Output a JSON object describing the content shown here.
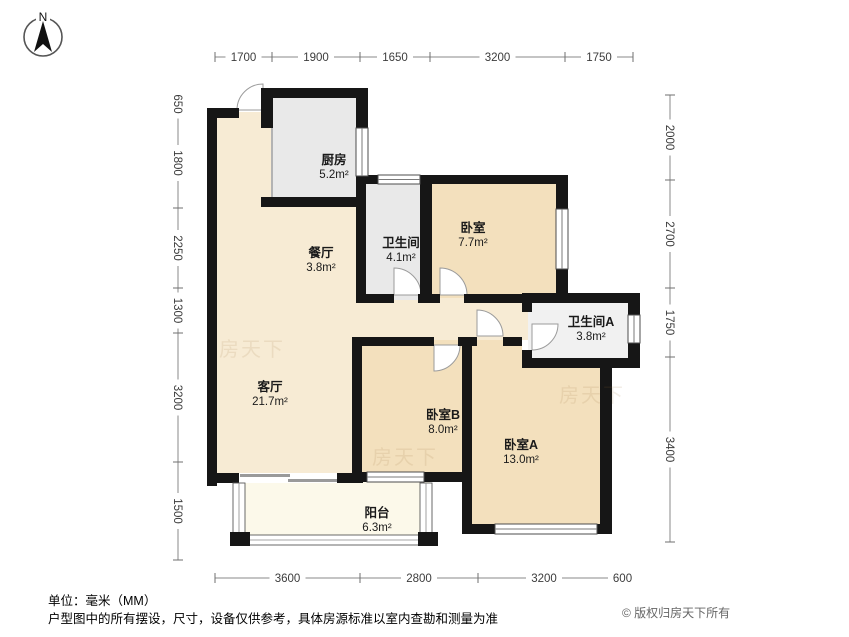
{
  "compass": {
    "label": "N"
  },
  "rooms": [
    {
      "id": "kitchen",
      "name": "厨房",
      "area": "5.2m²",
      "label_x": 334,
      "label_y": 164
    },
    {
      "id": "bathroom",
      "name": "卫生间",
      "area": "4.1m²",
      "label_x": 401,
      "label_y": 247
    },
    {
      "id": "bedroom-north",
      "name": "卧室",
      "area": "7.7m²",
      "label_x": 473,
      "label_y": 232
    },
    {
      "id": "dining-room",
      "name": "餐厅",
      "area": "3.8m²",
      "label_x": 321,
      "label_y": 257
    },
    {
      "id": "bathroom-a",
      "name": "卫生间A",
      "area": "3.8m²",
      "label_x": 591,
      "label_y": 326
    },
    {
      "id": "living-room",
      "name": "客厅",
      "area": "21.7m²",
      "label_x": 270,
      "label_y": 391
    },
    {
      "id": "bedroom-b",
      "name": "卧室B",
      "area": "8.0m²",
      "label_x": 443,
      "label_y": 419
    },
    {
      "id": "bedroom-a",
      "name": "卧室A",
      "area": "13.0m²",
      "label_x": 521,
      "label_y": 449
    },
    {
      "id": "balcony",
      "name": "阳台",
      "area": "6.3m²",
      "label_x": 377,
      "label_y": 517
    }
  ],
  "dimensions": {
    "top": {
      "orient": "h",
      "pos": 57,
      "segments": [
        {
          "label": "1700",
          "a": 215,
          "b": 272
        },
        {
          "label": "1900",
          "a": 272,
          "b": 360
        },
        {
          "label": "1650",
          "a": 360,
          "b": 430
        },
        {
          "label": "3200",
          "a": 430,
          "b": 565
        },
        {
          "label": "1750",
          "a": 565,
          "b": 633
        }
      ]
    },
    "bottom": {
      "orient": "h",
      "pos": 578,
      "segments": [
        {
          "label": "3600",
          "a": 215,
          "b": 360
        },
        {
          "label": "2800",
          "a": 360,
          "b": 478
        },
        {
          "label": "3200",
          "a": 478,
          "b": 610
        },
        {
          "label": "600",
          "a": 610,
          "b": 635
        }
      ]
    },
    "left": {
      "orient": "v",
      "pos": 178,
      "segments": [
        {
          "label": "650",
          "a": 90,
          "b": 118
        },
        {
          "label": "1800",
          "a": 118,
          "b": 208
        },
        {
          "label": "2250",
          "a": 208,
          "b": 288
        },
        {
          "label": "1300",
          "a": 288,
          "b": 333
        },
        {
          "label": "3200",
          "a": 333,
          "b": 462
        },
        {
          "label": "1500",
          "a": 462,
          "b": 560
        }
      ]
    },
    "right": {
      "orient": "v",
      "pos": 670,
      "segments": [
        {
          "label": "2000",
          "a": 95,
          "b": 180
        },
        {
          "label": "2700",
          "a": 180,
          "b": 288
        },
        {
          "label": "1750",
          "a": 288,
          "b": 357
        },
        {
          "label": "3400",
          "a": 357,
          "b": 542
        }
      ]
    }
  },
  "watermarks": [
    {
      "text": "房天下",
      "x": 252,
      "y": 356
    },
    {
      "text": "房天下",
      "x": 405,
      "y": 464
    },
    {
      "text": "房天下",
      "x": 592,
      "y": 402
    }
  ],
  "footer": {
    "unit_note": "单位：毫米（MM）",
    "disclaimer": "户型图中的所有摆设，尺寸，设备仅供参考，具体房源标准以室内查勘和测量为准",
    "copyright": "© 版权归房天下所有"
  },
  "colors": {
    "wall": "#161616",
    "room_light": "#f7ebd4",
    "room_bedroom": "#f3e0bd",
    "room_gray": "#e9e9e9",
    "room_gray_light": "#f1f1f1",
    "balcony": "#fcf9ea",
    "dim_line": "#8a8a8a",
    "dim_text": "#3c3c3c",
    "label": "#1a1a1a"
  }
}
